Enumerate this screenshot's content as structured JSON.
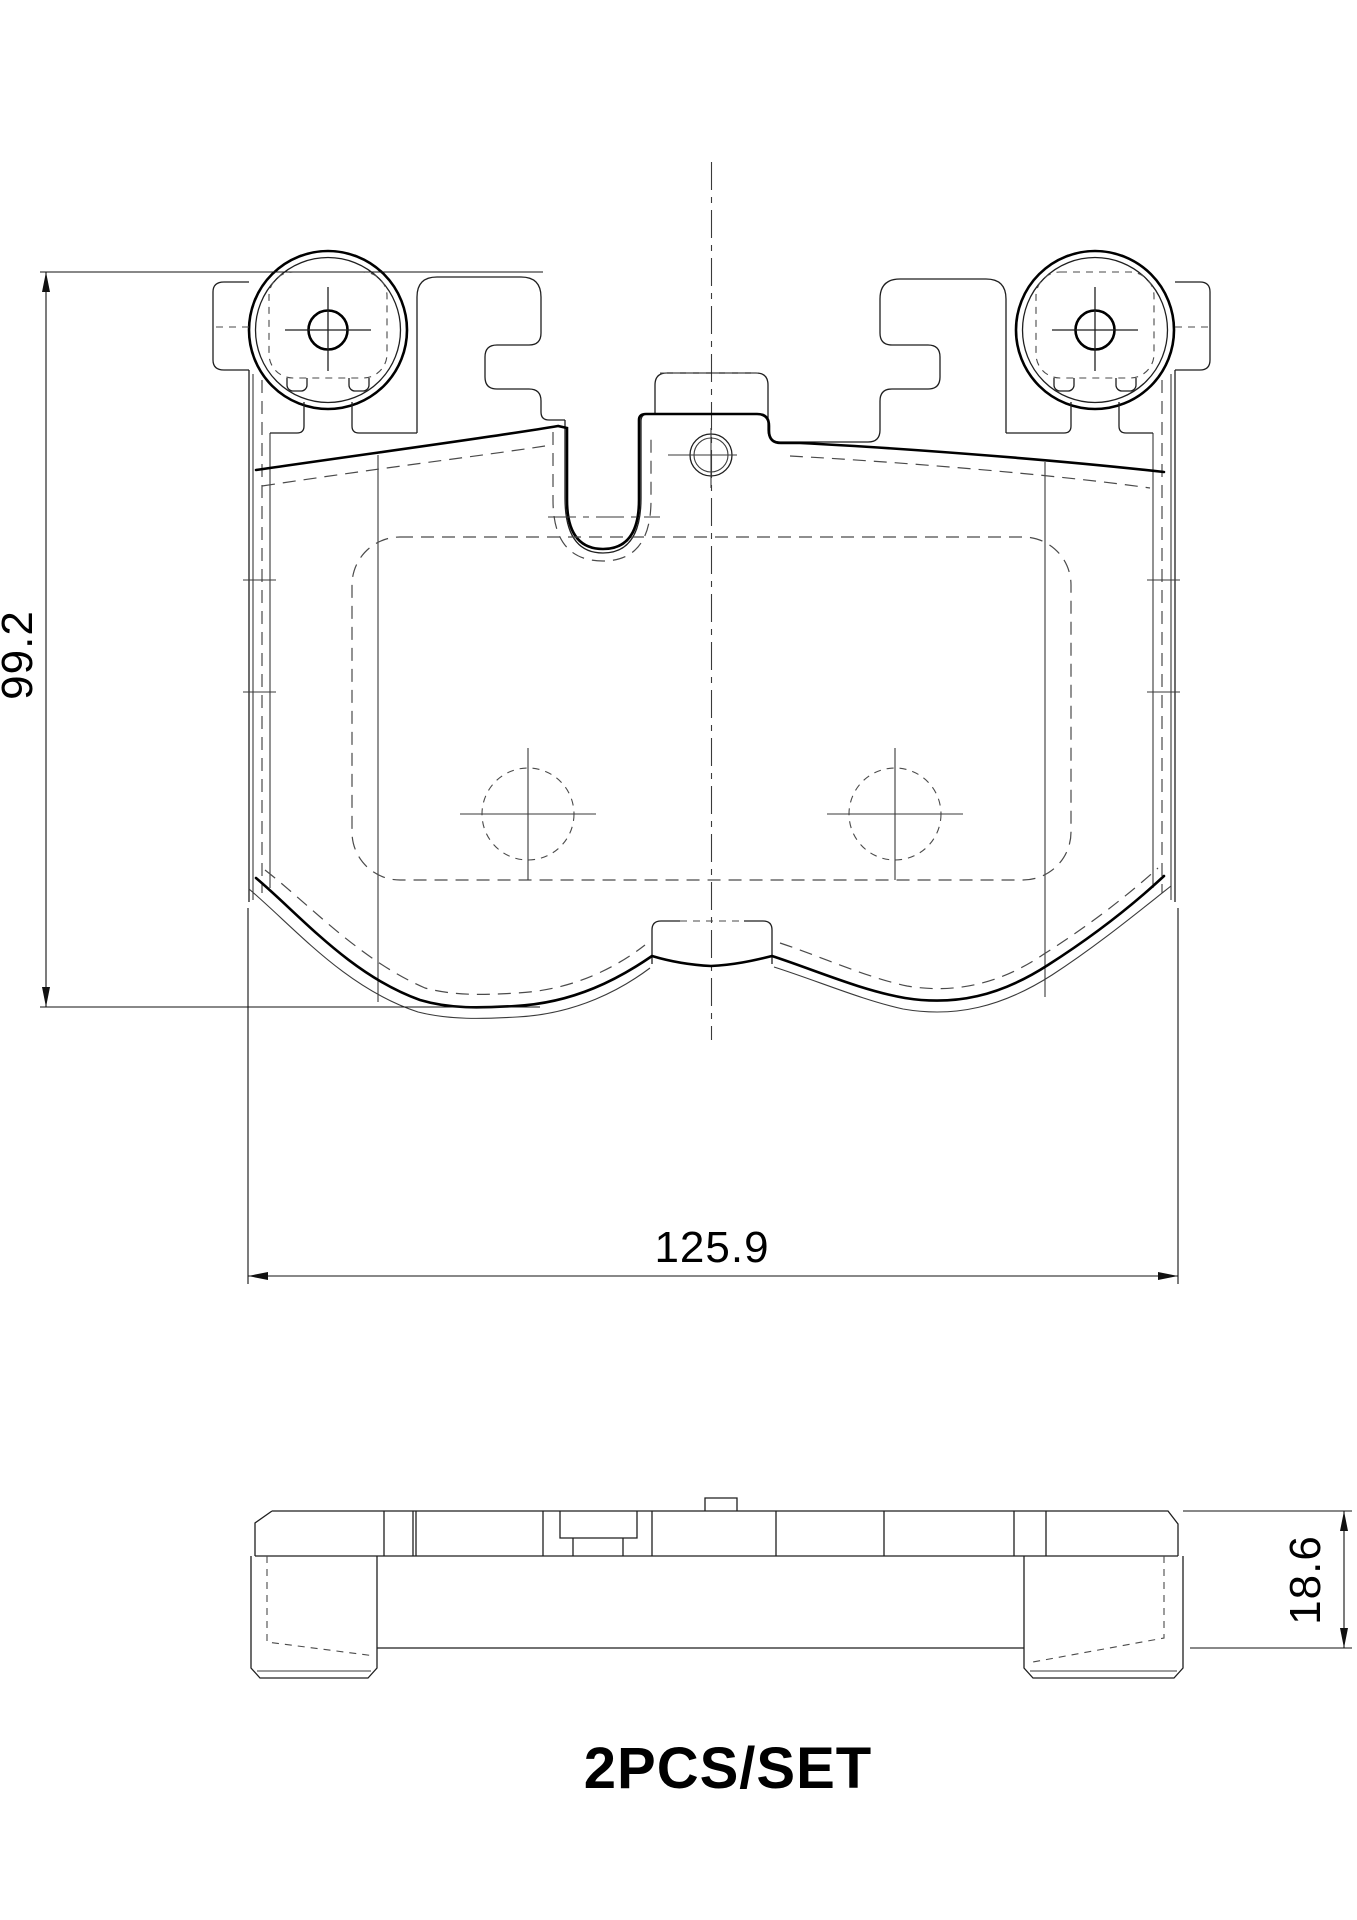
{
  "drawing": {
    "type": "technical-drawing",
    "subject": "brake-pad-set",
    "background_color": "#ffffff",
    "line_color": "#000000",
    "views": {
      "front_view": {
        "name": "brake pad front elevation",
        "features": [
          "left-ear-guide-circle",
          "right-ear-guide-circle",
          "two-center-holes",
          "top-center-pin-hole",
          "u-notch",
          "friction-material-outline",
          "hidden-chamfer-dashed-outline",
          "vertical-centerline"
        ]
      },
      "side_view": {
        "name": "brake pad edge profile",
        "features": [
          "backing-plate-strip",
          "left-friction-block",
          "right-friction-block",
          "top-tab",
          "center-notch"
        ]
      }
    },
    "dimensions": {
      "height": {
        "value": "99.2",
        "unit": "mm",
        "orientation": "vertical-left"
      },
      "width": {
        "value": "125.9",
        "unit": "mm",
        "orientation": "horizontal-bottom"
      },
      "thickness": {
        "value": "18.6",
        "unit": "mm",
        "orientation": "vertical-right"
      }
    },
    "caption": {
      "text": "2PCS/SET"
    }
  }
}
